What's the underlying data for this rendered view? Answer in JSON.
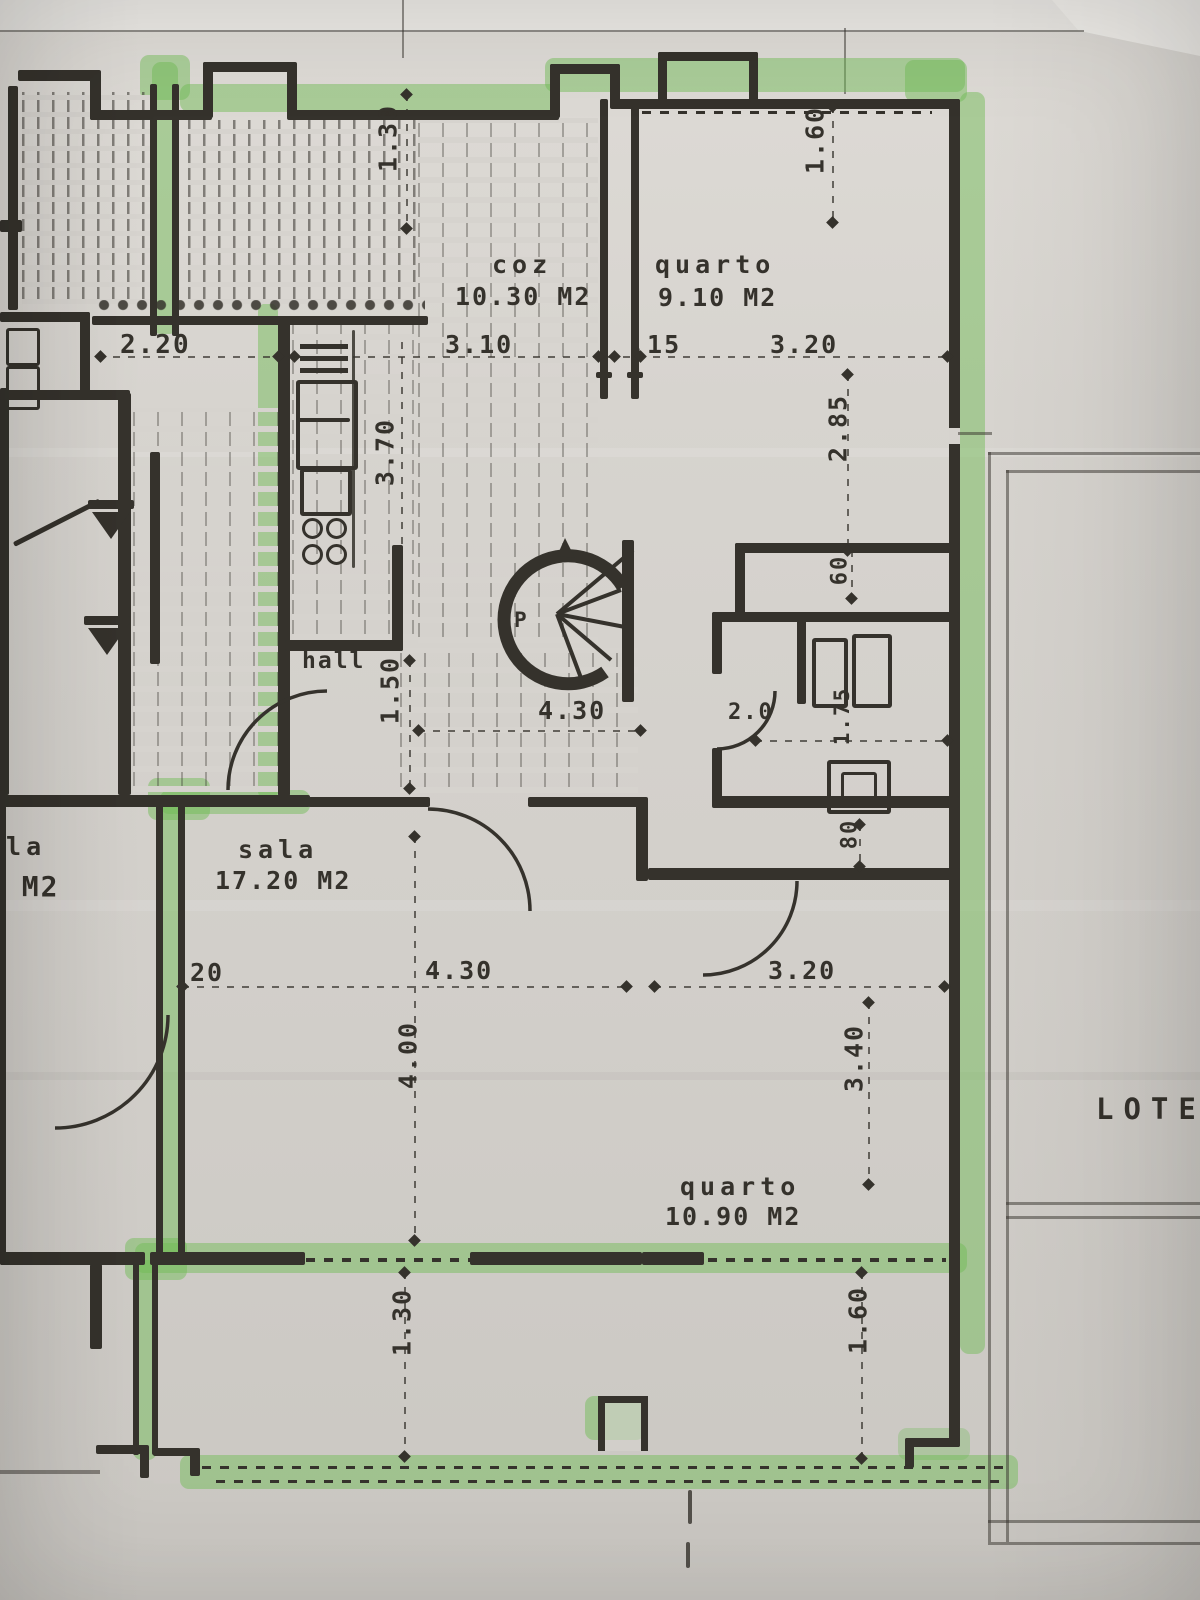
{
  "drawing": {
    "type": "hand-drawn apartment floor plan, photographed, perimeter walls traced with green highlighter",
    "ink_color": "#35322c",
    "paper_color": "#d6d3ce",
    "highlighter_color": "#70bc56"
  },
  "rooms": {
    "kitchen": {
      "name": "coz",
      "area": "10.30 M2"
    },
    "bedroom1": {
      "name": "quarto",
      "area": "9.10 M2"
    },
    "living": {
      "name": "sala",
      "area": "17.20 M2"
    },
    "bedroom2": {
      "name": "quarto",
      "area": "10.90 M2"
    },
    "hall": {
      "name": "hall"
    },
    "stair": {
      "label": "P"
    },
    "neighbor": {
      "name_partial": "ala",
      "area_partial": "0 M2"
    },
    "lot": {
      "label": "LOTE"
    }
  },
  "dimensions": {
    "terrace_width": "2.20",
    "balcony_top_depth": "1.30",
    "kitchen_width": "3.10",
    "wall_offset": ".15",
    "bedroom1_width": "3.20",
    "bedroom1_window": "1.60",
    "kitchen_depth": "3.70",
    "bedroom1_depth": "2.85",
    "closet_depth": "60",
    "hall_width": "1.50",
    "corridor_length": "4.30",
    "bath_door": "2.0",
    "bath_width": "1.75",
    "passage_width": "80",
    "living_offset": "20",
    "living_width": "4.30",
    "living_depth": "4.00",
    "bedroom2_width": "3.20",
    "bedroom2_depth": "3.40",
    "balcony_bottom_left": "1.30",
    "balcony_bottom_right": "1.60"
  }
}
